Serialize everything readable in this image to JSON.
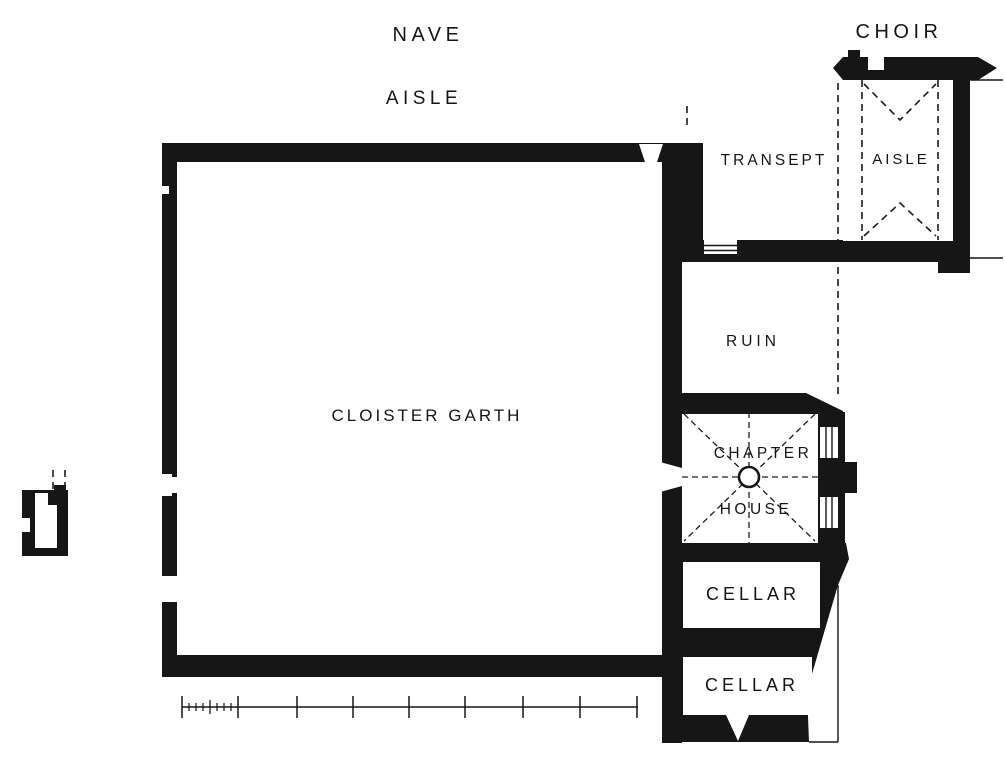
{
  "figure": {
    "type": "architectural-floor-plan",
    "subject": "Monastic cloister ground plan"
  },
  "colors": {
    "ink": "#161616",
    "paper": "#ffffff"
  },
  "labels": {
    "nave": "NAVE",
    "nave_aisle": "AISLE",
    "choir": "CHOIR",
    "transept": "TRANSEPT",
    "choir_aisle": "AISLE",
    "ruin": "RUIN",
    "cloister_garth": "CLOISTER GARTH",
    "chapter_line1": "CHAPTER",
    "chapter_line2": "HOUSE",
    "cellar_upper": "CELLAR",
    "cellar_lower": "CELLAR"
  }
}
